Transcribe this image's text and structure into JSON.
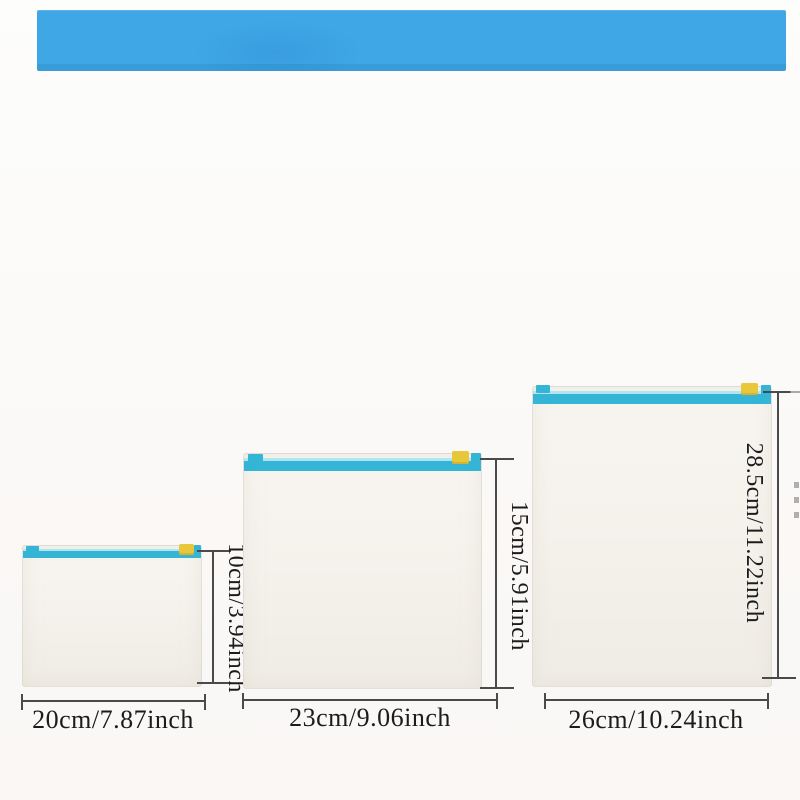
{
  "banner": {
    "description": "solid blue promotional banner, no visible text",
    "color": "#3fa7e6"
  },
  "bags": [
    {
      "size": "small",
      "width_label": "20cm/7.87inch",
      "height_label": "10cm/3.94inch"
    },
    {
      "size": "medium",
      "width_label": "23cm/9.06inch",
      "height_label": "15cm/5.91inch"
    },
    {
      "size": "large",
      "width_label": "26cm/10.24inch",
      "height_label": "28.5cm/11.22inch"
    }
  ],
  "colors": {
    "banner_blue": "#3fa7e6",
    "zipper_teal": "#35b5d6",
    "zipper_highlight": "#aee7f1",
    "slider_yellow": "#e9c73b",
    "bag_body": "#f5f2ec",
    "measure_line": "#4a4a4a",
    "label_text": "#1c1c1c",
    "background": "#fbf9f7"
  }
}
